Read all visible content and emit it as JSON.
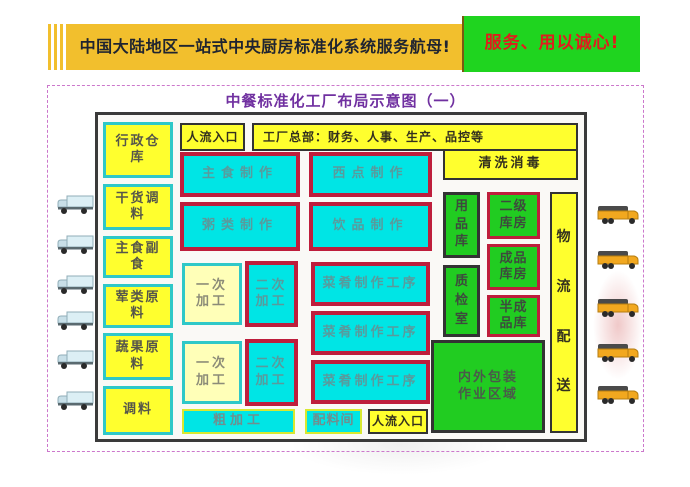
{
  "header": {
    "main_title": "中国大陆地区一站式中央厨房标准化系统服务航母!",
    "slogan": "服务、用以诚心!"
  },
  "diagram": {
    "title": "中餐标准化工厂布局示意图（一）",
    "entrance_top": "人流入口",
    "hq": "工厂总部：财务、人事、生产、品控等",
    "left_storage": [
      "行政仓库",
      "干货调料",
      "主食副食",
      "荤类原料",
      "蔬果原料",
      "调料"
    ],
    "production": {
      "staple": "主食制作",
      "pastry": "西点制作",
      "porridge": "粥类制作",
      "beverage": "饮品制作"
    },
    "cleaning": "清洗消毒",
    "rooms": {
      "supplies": "用品库",
      "qc": "质检室",
      "secondary": "二级库房",
      "finished": "成品库房",
      "semi": "半成品库",
      "packaging": "内外包装作业区域",
      "logistics": "物流配送"
    },
    "processing": {
      "primary_1": "一次加工",
      "secondary_1": "二次加工",
      "primary_2": "一次加工",
      "secondary_2": "二次加工",
      "dish_1": "菜肴制作工序",
      "dish_2": "菜肴制作工序",
      "dish_3": "菜肴制作工序",
      "rough": "粗加工",
      "ingredients": "配料间",
      "entrance_bottom": "人流入口"
    }
  },
  "colors": {
    "header-yellow": "#f2bf2d",
    "slogan-green": "#1fd41f",
    "slogan-red": "#e01d1d",
    "title-purple": "#7030a0",
    "cyan": "#00e5e5",
    "crimson": "#be1e3c",
    "yellow": "#ffff2e",
    "teal": "#2fc8c8",
    "green": "#21cc21",
    "cream": "#ffffb8",
    "lime": "#d8e830"
  }
}
